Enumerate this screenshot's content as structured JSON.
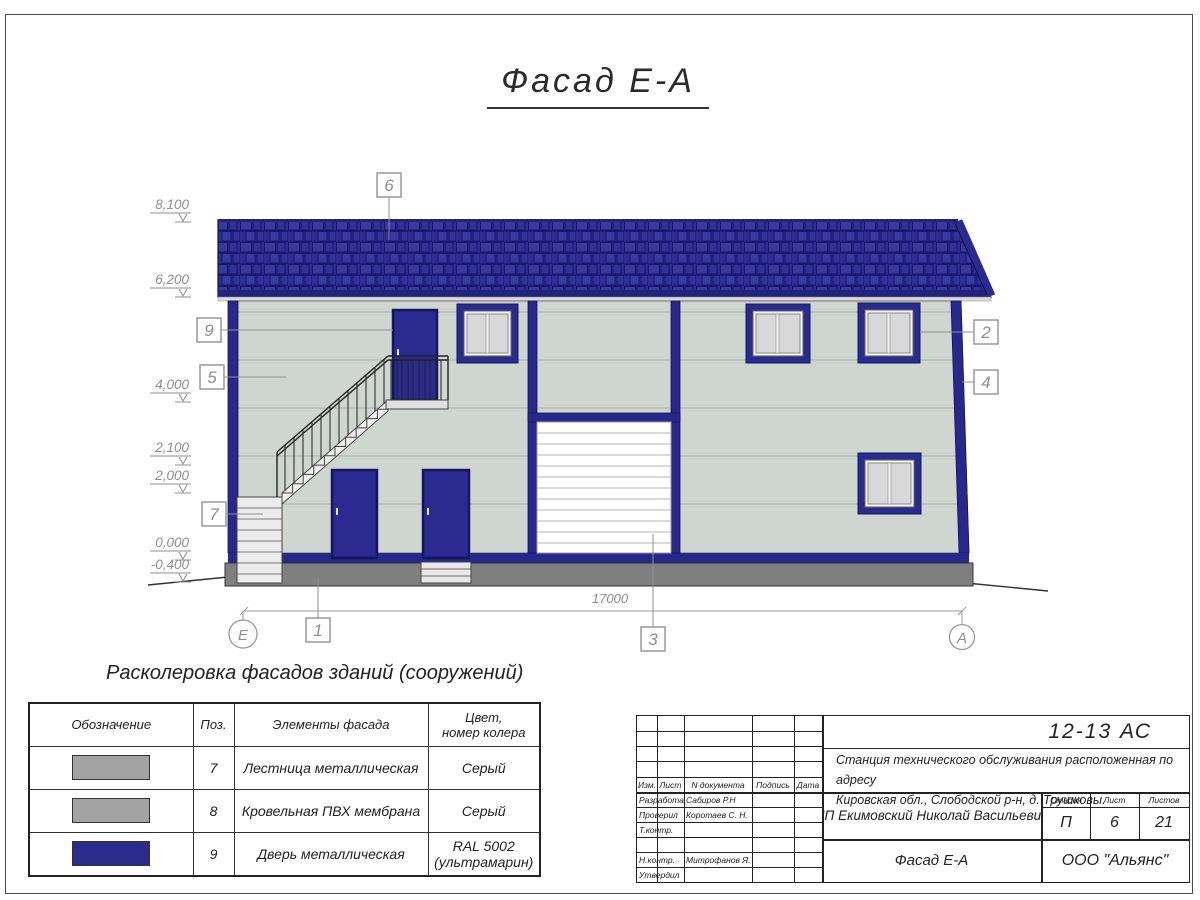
{
  "title": "Фасад Е-А",
  "colors": {
    "roof_navy": "#2e2e96",
    "trim_navy": "#2b2b8c",
    "wall": "#cfd6d0",
    "plinth_gray": "#7f7f7f",
    "legend_gray": "#a3a3a3",
    "legend_navy": "#2b2b8c",
    "annotation_gray": "#8f8f8f"
  },
  "drawing": {
    "elevations": [
      "8,100",
      "6,200",
      "4,000",
      "2,100",
      "2,000",
      "0,000",
      "-0,400"
    ],
    "callouts": {
      "n6": "6",
      "n9": "9",
      "n5": "5",
      "n7": "7",
      "n1": "1",
      "n3": "3",
      "n2": "2",
      "n4": "4"
    },
    "axis_left": "Е",
    "axis_right": "А",
    "overall_dim": "17000"
  },
  "legend": {
    "title": "Расколеровка фасадов зданий (сооружений)",
    "col_designation": "Обозначение",
    "col_pos": "Поз.",
    "col_element": "Элементы фасада",
    "col_color_l1": "Цвет,",
    "col_color_l2": "номер колера",
    "rows": [
      {
        "pos": "7",
        "element": "Лестница металлическая",
        "color_l1": "Серый",
        "color_l2": "",
        "swatch": "#a3a3a3"
      },
      {
        "pos": "8",
        "element": "Кровельная ПВХ мембрана",
        "color_l1": "Серый",
        "color_l2": "",
        "swatch": "#a3a3a3"
      },
      {
        "pos": "9",
        "element": "Дверь металлическая",
        "color_l1": "RAL 5002",
        "color_l2": "(ультрамарин)",
        "swatch": "#2b2b8c"
      }
    ]
  },
  "titleblock": {
    "doc_number": "12-13 АС",
    "project_line1": "Станция технического обслуживания расположенная по адресу",
    "project_line2": "Кировская обл., Слободской р-н, д. Трушковы.",
    "client": "ИП Екимовский Николай Васильевич",
    "sheet_title": "Фасад Е-А",
    "company": "ООО \"Альянс\"",
    "col_izm": "Изм.",
    "col_list": "Лист",
    "col_ndoc": "N документа",
    "col_podpis": "Подпись",
    "col_data": "Дата",
    "stage_label": "Стадия",
    "sheet_label": "Лист",
    "sheets_label": "Листов",
    "stage": "П",
    "sheet": "6",
    "sheets": "21",
    "roles": [
      {
        "role": "Разработал",
        "name": "Сабиров Р.Н"
      },
      {
        "role": "Проверил",
        "name": "Коротаев С. Н."
      },
      {
        "role": "Т.контр.",
        "name": ""
      },
      {
        "role": "",
        "name": ""
      },
      {
        "role": "Н.контр.",
        "name": "Митрофанов Я. А."
      },
      {
        "role": "Утвердил",
        "name": ""
      }
    ]
  }
}
